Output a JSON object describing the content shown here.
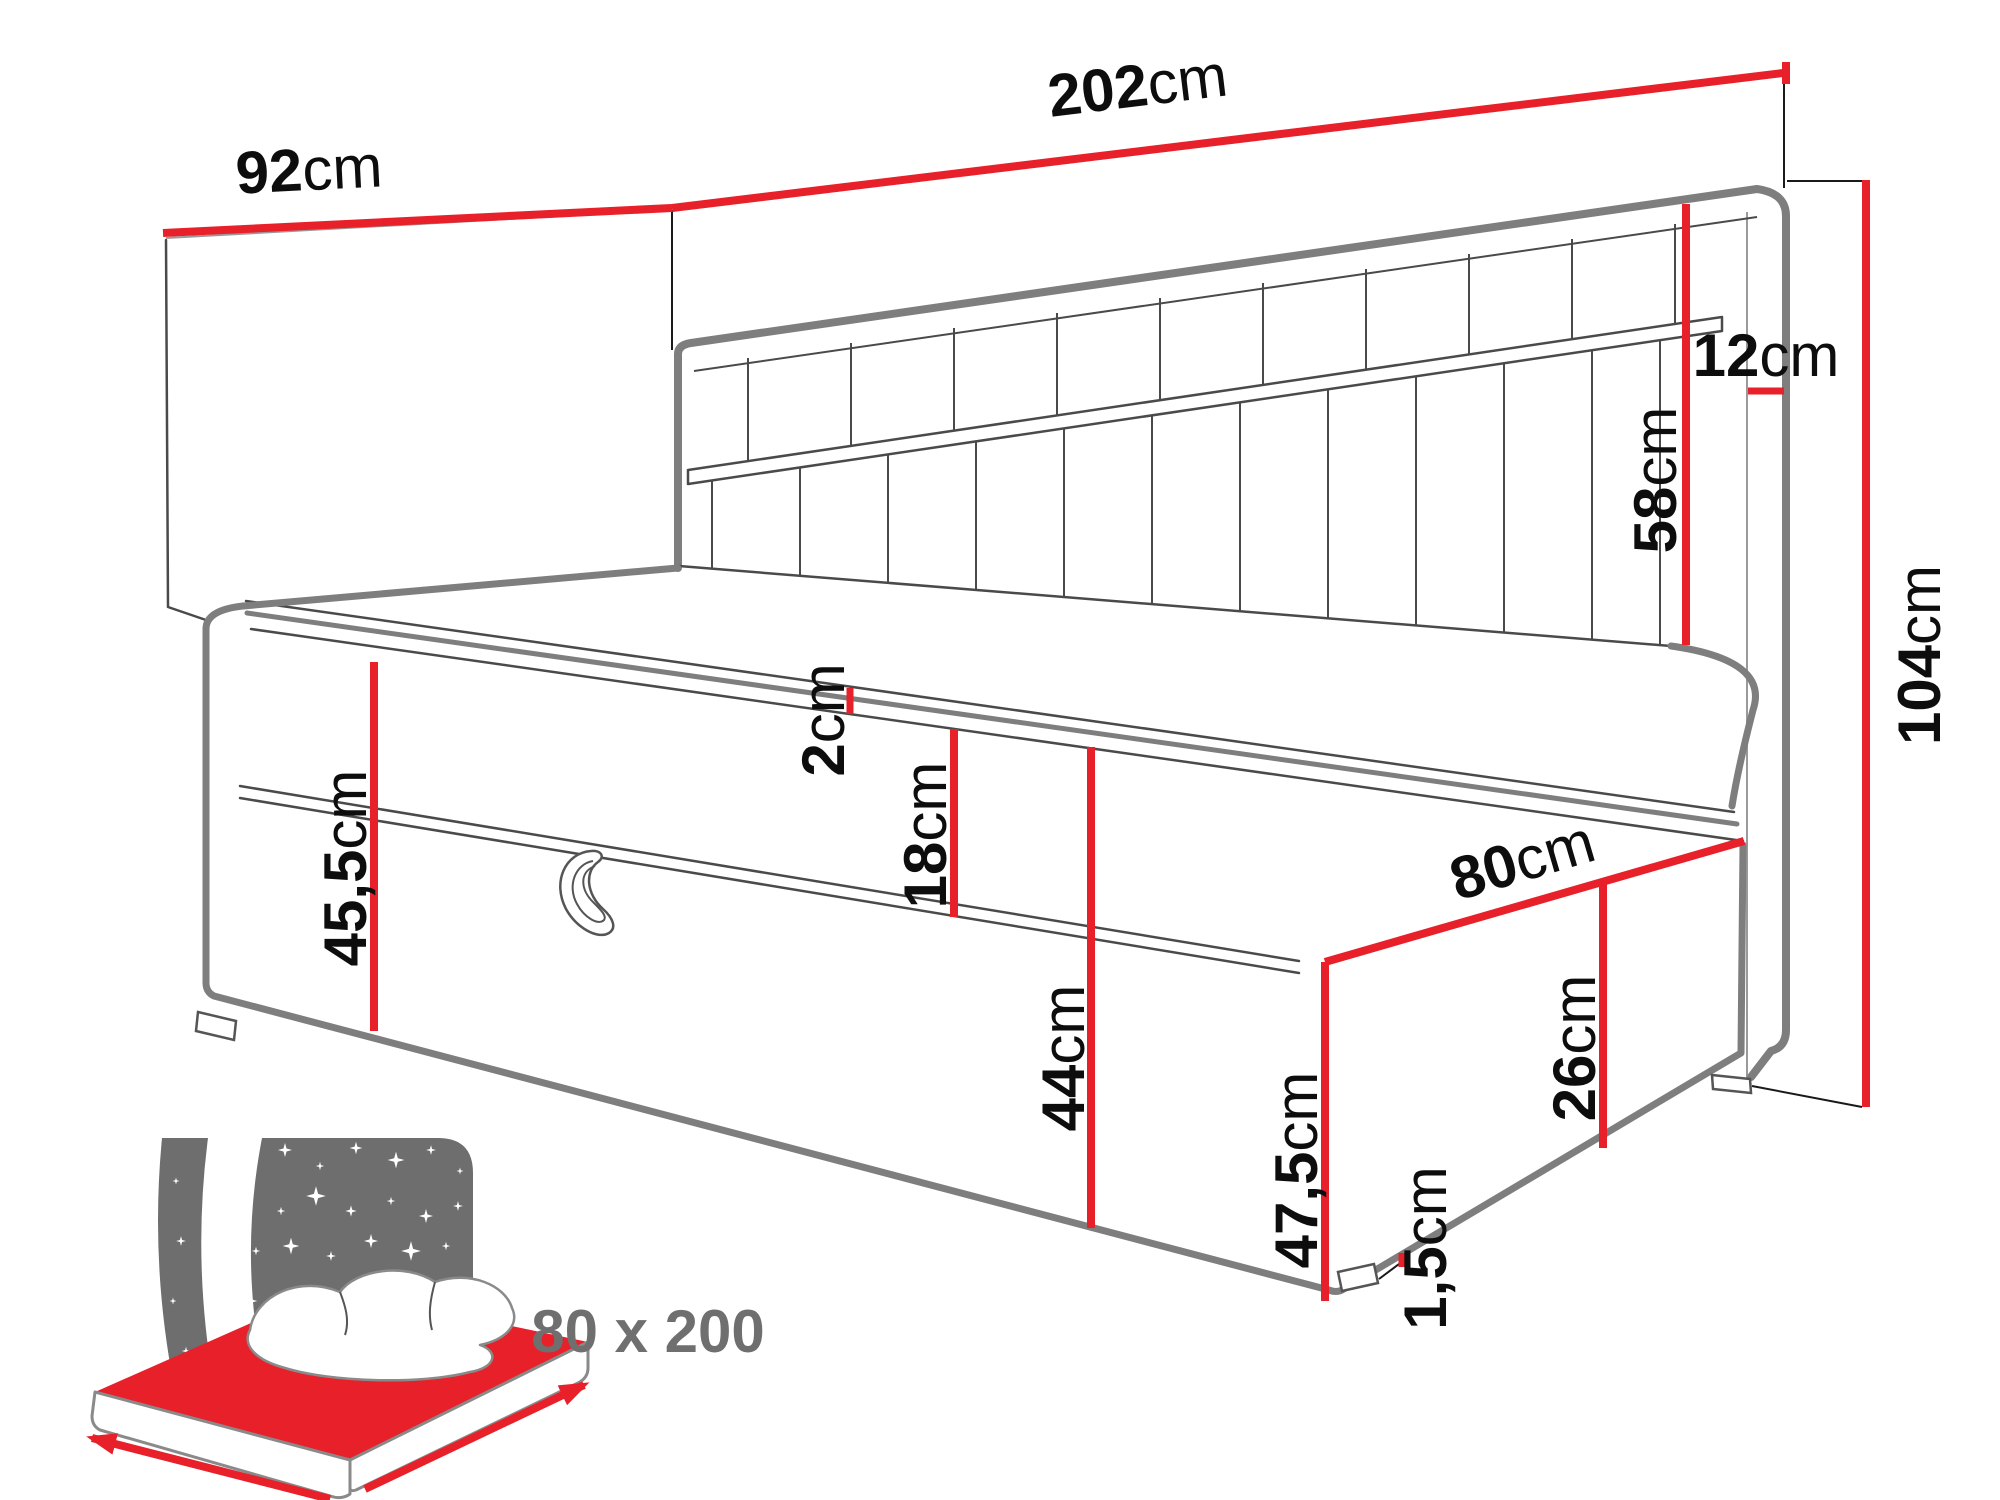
{
  "colors": {
    "dimension_red": "#e7202a",
    "outline_gray": "#7e7e7e",
    "detail_line": "#4a4a4a",
    "icon_gray": "#6e6e6e",
    "text_black": "#0d0d0d"
  },
  "dims": {
    "d92": {
      "value": "92",
      "unit": "cm"
    },
    "d202": {
      "value": "202",
      "unit": "cm"
    },
    "d12": {
      "value": "12",
      "unit": "cm"
    },
    "d58": {
      "value": "58",
      "unit": "cm"
    },
    "d104": {
      "value": "104",
      "unit": "cm"
    },
    "d45_5": {
      "value": "45,5",
      "unit": "cm"
    },
    "d2": {
      "value": "2",
      "unit": "cm"
    },
    "d18": {
      "value": "18",
      "unit": "cm"
    },
    "d44": {
      "value": "44",
      "unit": "cm"
    },
    "d80": {
      "value": "80",
      "unit": "cm"
    },
    "d26": {
      "value": "26",
      "unit": "cm"
    },
    "d47_5": {
      "value": "47,5",
      "unit": "cm"
    },
    "d1_5": {
      "value": "1,5",
      "unit": "cm"
    }
  },
  "icon": {
    "label": "80 x 200"
  }
}
